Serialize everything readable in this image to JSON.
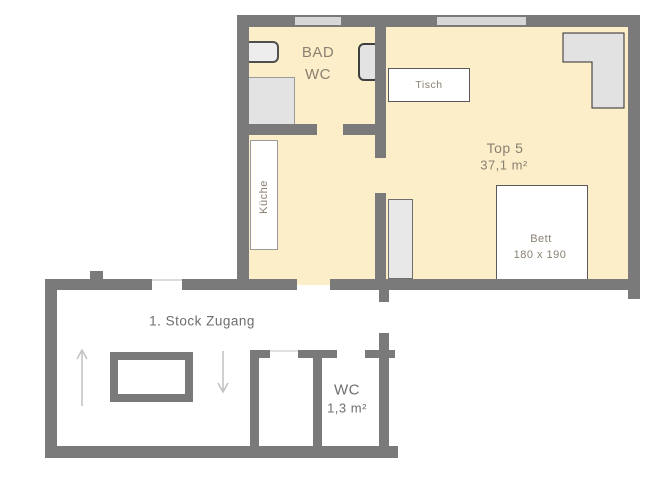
{
  "apartment": {
    "bathroom": {
      "line1": "BAD",
      "line2": "WC"
    },
    "kitchen_label": "Küche",
    "table_label": "Tisch",
    "unit": {
      "name": "Top 5",
      "area": "37,1 m²"
    },
    "bed": {
      "label": "Bett",
      "dimensions": "180 x 190"
    }
  },
  "landing": {
    "label": "1. Stock Zugang",
    "wc": {
      "label": "WC",
      "area": "1,3 m²"
    }
  },
  "colors": {
    "wall": "#7a7a7a",
    "window": "#d7d7d7",
    "floor": "#fbeec8",
    "furn": "#e3e3e3",
    "txt_apt": "#8a8173",
    "txt_low": "#6e6e6e",
    "arrow": "#c1c1c1"
  }
}
